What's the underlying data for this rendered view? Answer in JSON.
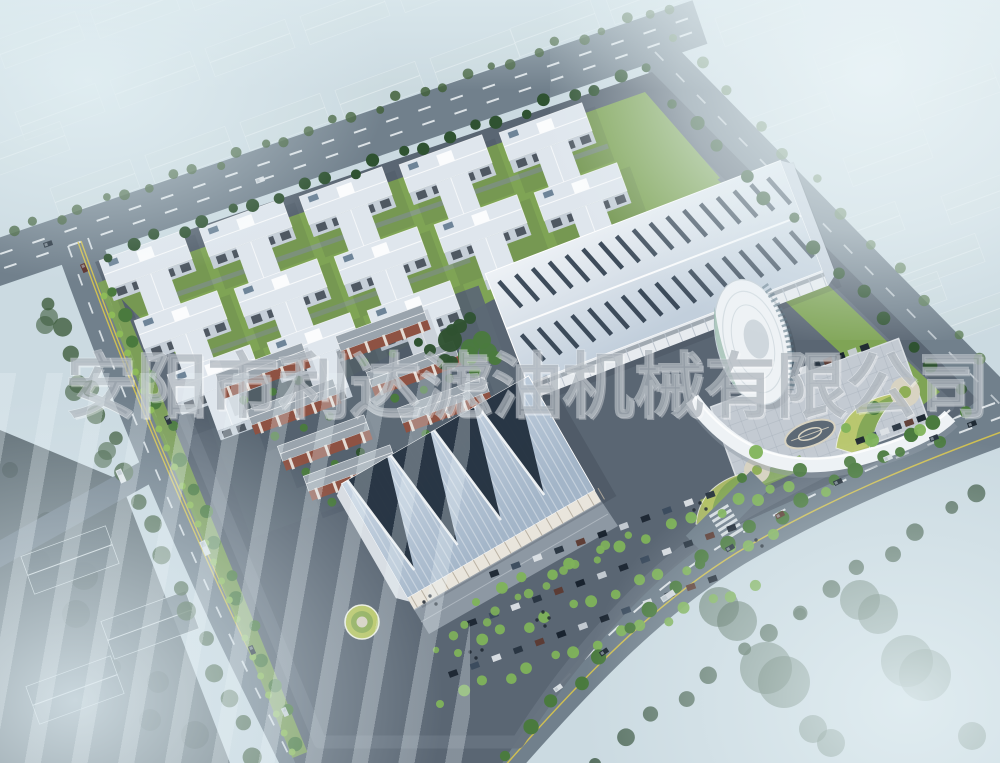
{
  "watermark": {
    "text": "安阳市利达滤油机械有限公司"
  },
  "scene": {
    "description": "aerial rendering of an industrial park campus",
    "counts": {
      "factory_workshops": 13,
      "dormitory_blocks": 7,
      "sawtooth_roof_peaks": 4
    }
  },
  "palette": {
    "haze": "#cfdfe6",
    "ghost": "#ccdade",
    "roadOuter": "#71808c",
    "roadDark": "#55626e",
    "laneWhite": "#eef3f6",
    "laneYellow": "#d9c54b",
    "verge": "#7da355",
    "hedge": "#8fbe58",
    "treeDark": "#2f5231",
    "treeMid": "#4a7a3e",
    "treeLight": "#7fb35a",
    "lawn": "#7fa455",
    "lawnYellow": "#b9c765",
    "asphalt": "#5a6673",
    "pad": "#5d6975",
    "factoryRoof": "#dfe6ed",
    "factoryWall": "#c6cfd8",
    "windowDark": "#39434e",
    "dormWall": "#8e5243",
    "dormRoof": "#9aa4ad",
    "hallRoof": "#b4c3d4",
    "hallWedge": "#22303e",
    "bigRoofA": "#eef2f6",
    "bigRoofB": "#c2cfdc",
    "skylight": "#2d3c4c",
    "towerWhite": "#eef2f5",
    "towerGlass": "#57707e",
    "plaza": "#c3cad2",
    "paving": "#d8d3c2",
    "watermark": "rgba(150,158,167,0.55)",
    "watermarkEdge": "rgba(246,249,251,0.45)"
  }
}
